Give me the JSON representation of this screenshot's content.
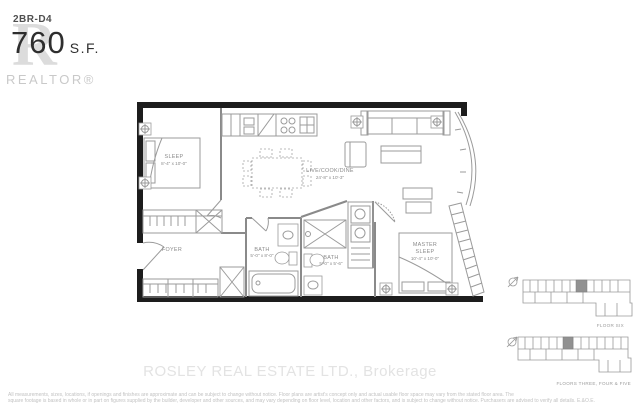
{
  "logo": {
    "glyph": "R",
    "unit": "2BR-D4",
    "area": "760",
    "area_unit": "S.F.",
    "brand": "REALTOR®"
  },
  "plan": {
    "rooms": {
      "sleep": {
        "name": "SLEEP",
        "dims": "8'-4\" x 10'-0\""
      },
      "live": {
        "name": "LIVE/COOK/DINE",
        "dims": "24'-8\" x 10'-3\""
      },
      "master": {
        "line1": "MASTER",
        "line2": "SLEEP",
        "dims": "10'-4\" x 10'-0\""
      },
      "bath1": {
        "name": "BATH",
        "dims": "5'-0\" x 8'-0\""
      },
      "bath2": {
        "name": "BATH",
        "dims": "5'-0\" x 5'-6\""
      },
      "foyer": {
        "name": "FOYER"
      }
    }
  },
  "keyplans": [
    {
      "label": "FLOOR SIX"
    },
    {
      "label": "FLOORS THREE, FOUR & FIVE"
    }
  ],
  "watermark": "ROSLEY REAL ESTATE LTD., Brokerage",
  "disclaimer": {
    "line1": "All measurements, sizes, locations, if openings and finishes are approximate and can be subject to change without notice. Floor plans are artist's concept only and actual usable floor space may vary from the stated floor area. The",
    "line2": "square footage is based in whole or in part on figures supplied by the builder, developer and other sources, and may vary depending on floor level, location and other factors, and is subject to change without notice. Purchasers are advised to verify all details. E.&O.E."
  },
  "colors": {
    "wall": "#1d1d1d",
    "drawing_line": "#9b9b9b",
    "logo_gray": "#dcdcdc",
    "watermark_gray": "#e3e3e3",
    "highlight_unit": "#919191"
  }
}
